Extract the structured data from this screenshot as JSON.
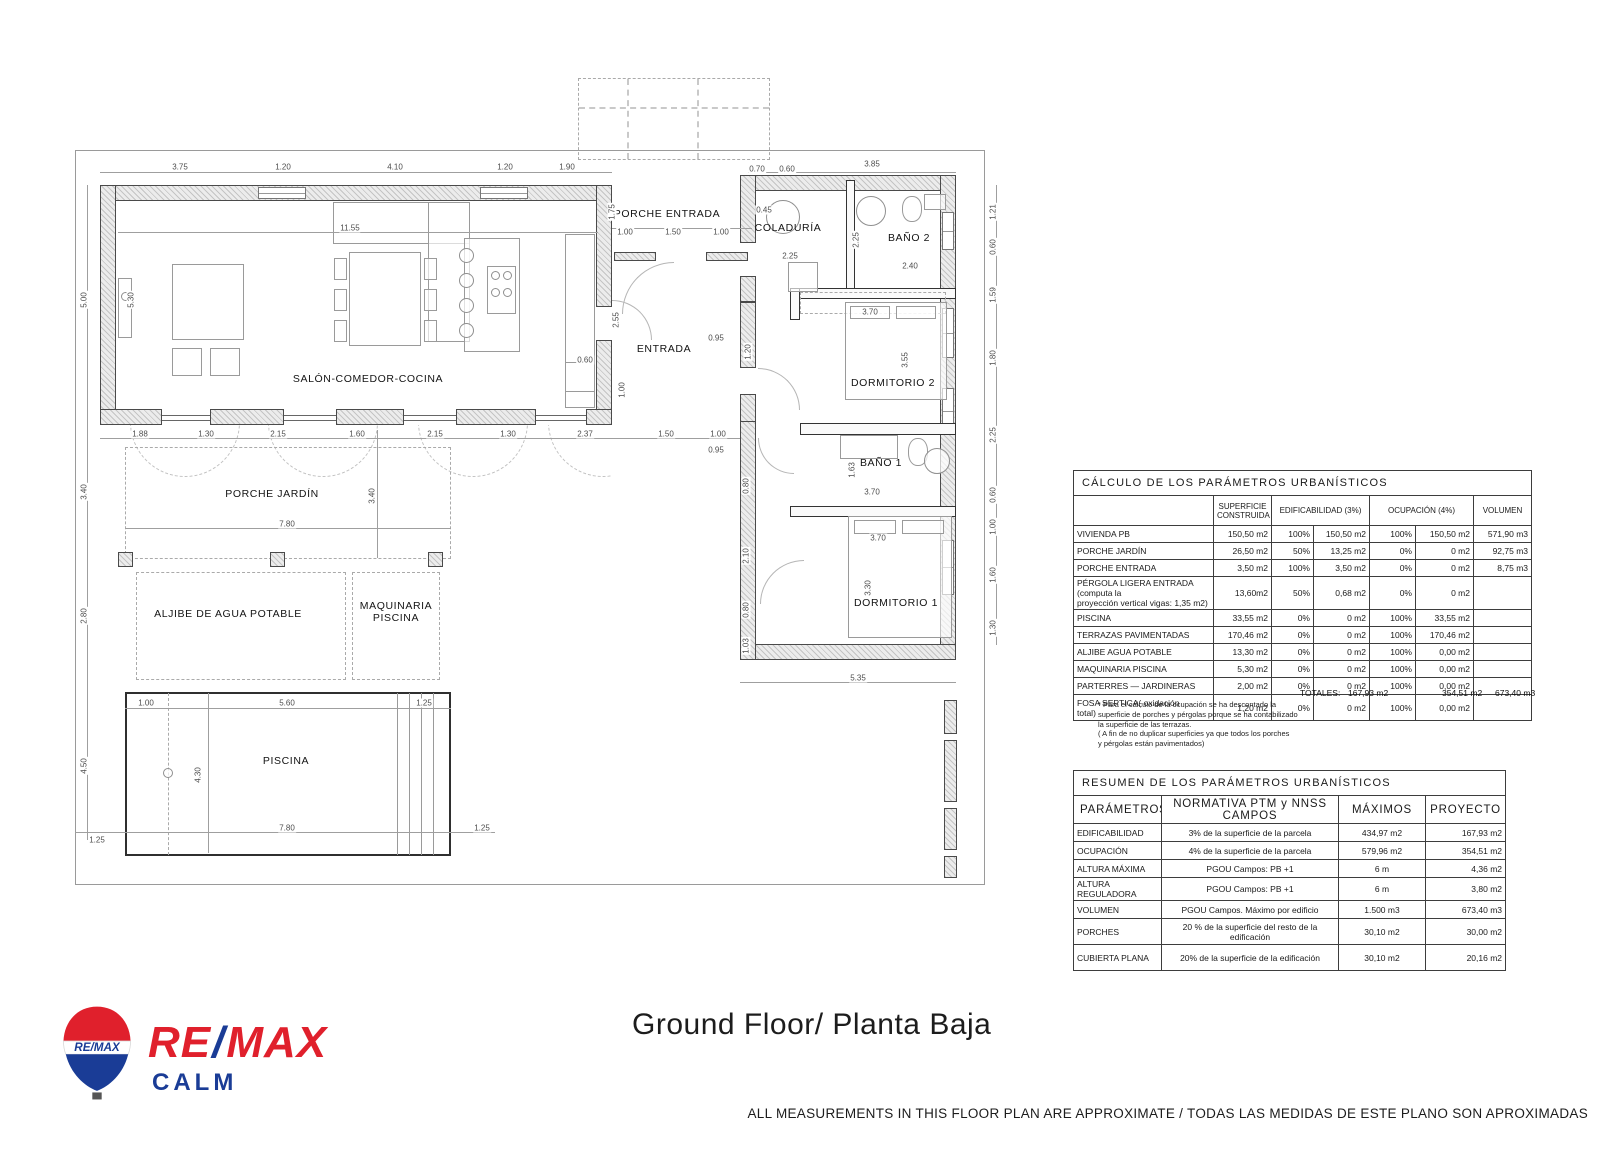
{
  "meta": {
    "title": "Ground Floor/ Planta Baja",
    "disclaimer": "ALL MEASUREMENTS IN THIS FLOOR PLAN ARE APPROXIMATE / TODAS LAS MEDIDAS DE ESTE PLANO SON APROXIMADAS"
  },
  "logo": {
    "balloon_text": "RE/MAX",
    "brand_left": "RE",
    "brand_slash": "/",
    "brand_right": "MAX",
    "office": "CALM",
    "red": "#e0202c",
    "blue": "#1a3c96"
  },
  "plan": {
    "rooms": [
      {
        "id": "salon",
        "label": "SALÓN-COMEDOR-COCINA",
        "x": 368,
        "y": 379
      },
      {
        "id": "porche-entrada",
        "label": "PORCHE ENTRADA",
        "x": 667,
        "y": 214
      },
      {
        "id": "coladuria",
        "label": "COLADURÍA",
        "x": 788,
        "y": 228
      },
      {
        "id": "bano-2",
        "label": "BAÑO 2",
        "x": 909,
        "y": 238
      },
      {
        "id": "entrada",
        "label": "ENTRADA",
        "x": 664,
        "y": 349
      },
      {
        "id": "dormitorio-2",
        "label": "DORMITORIO 2",
        "x": 893,
        "y": 383
      },
      {
        "id": "bano-1",
        "label": "BAÑO 1",
        "x": 881,
        "y": 463
      },
      {
        "id": "dormitorio-1",
        "label": "DORMITORIO 1",
        "x": 896,
        "y": 603
      },
      {
        "id": "porche-jardin",
        "label": "PORCHE JARDÍN",
        "x": 272,
        "y": 494
      },
      {
        "id": "aljibe",
        "label": "ALJIBE DE AGUA POTABLE",
        "x": 228,
        "y": 614
      },
      {
        "id": "maquinaria",
        "label": "MAQUINARIA\nPISCINA",
        "x": 396,
        "y": 612
      },
      {
        "id": "piscina",
        "label": "PISCINA",
        "x": 286,
        "y": 761
      }
    ],
    "dimensions": [
      {
        "t": "3.75",
        "x": 180,
        "y": 167
      },
      {
        "t": "1.20",
        "x": 283,
        "y": 167
      },
      {
        "t": "4.10",
        "x": 395,
        "y": 167
      },
      {
        "t": "1.20",
        "x": 505,
        "y": 167
      },
      {
        "t": "1.90",
        "x": 567,
        "y": 167
      },
      {
        "t": "0.70",
        "x": 757,
        "y": 169
      },
      {
        "t": "0.60",
        "x": 787,
        "y": 169
      },
      {
        "t": "3.85",
        "x": 872,
        "y": 164
      },
      {
        "t": "11.55",
        "x": 350,
        "y": 228
      },
      {
        "t": "5.00",
        "x": 84,
        "y": 300,
        "r": 1
      },
      {
        "t": "5.30",
        "x": 131,
        "y": 300,
        "r": 1
      },
      {
        "t": "3.40",
        "x": 84,
        "y": 492,
        "r": 1
      },
      {
        "t": "2.80",
        "x": 84,
        "y": 616,
        "r": 1
      },
      {
        "t": "4.50",
        "x": 84,
        "y": 766,
        "r": 1
      },
      {
        "t": "1.25",
        "x": 97,
        "y": 840
      },
      {
        "t": "1.88",
        "x": 140,
        "y": 434
      },
      {
        "t": "1.30",
        "x": 206,
        "y": 434
      },
      {
        "t": "2.15",
        "x": 278,
        "y": 434
      },
      {
        "t": "1.60",
        "x": 357,
        "y": 434
      },
      {
        "t": "2.15",
        "x": 435,
        "y": 434
      },
      {
        "t": "1.30",
        "x": 508,
        "y": 434
      },
      {
        "t": "2.37",
        "x": 585,
        "y": 434
      },
      {
        "t": "1.50",
        "x": 666,
        "y": 434
      },
      {
        "t": "1.00",
        "x": 718,
        "y": 434
      },
      {
        "t": "7.80",
        "x": 287,
        "y": 524
      },
      {
        "t": "3.40",
        "x": 372,
        "y": 496,
        "r": 1
      },
      {
        "t": "1.00",
        "x": 146,
        "y": 703
      },
      {
        "t": "5.60",
        "x": 287,
        "y": 703
      },
      {
        "t": "1.25",
        "x": 424,
        "y": 703
      },
      {
        "t": "4.30",
        "x": 198,
        "y": 775,
        "r": 1
      },
      {
        "t": "7.80",
        "x": 287,
        "y": 828
      },
      {
        "t": "1.25",
        "x": 482,
        "y": 828
      },
      {
        "t": "1.00",
        "x": 625,
        "y": 232
      },
      {
        "t": "1.50",
        "x": 673,
        "y": 232
      },
      {
        "t": "1.00",
        "x": 721,
        "y": 232
      },
      {
        "t": "1.75",
        "x": 612,
        "y": 212,
        "r": 1
      },
      {
        "t": "2.55",
        "x": 616,
        "y": 320,
        "r": 1
      },
      {
        "t": "0.60",
        "x": 585,
        "y": 360
      },
      {
        "t": "1.00",
        "x": 622,
        "y": 390,
        "r": 1
      },
      {
        "t": "0.95",
        "x": 716,
        "y": 338
      },
      {
        "t": "1.20",
        "x": 748,
        "y": 352,
        "r": 1
      },
      {
        "t": "0.45",
        "x": 764,
        "y": 210
      },
      {
        "t": "2.25",
        "x": 790,
        "y": 256
      },
      {
        "t": "2.25",
        "x": 856,
        "y": 240,
        "r": 1
      },
      {
        "t": "2.40",
        "x": 910,
        "y": 266
      },
      {
        "t": "3.70",
        "x": 870,
        "y": 312
      },
      {
        "t": "3.55",
        "x": 905,
        "y": 360,
        "r": 1
      },
      {
        "t": "0.95",
        "x": 716,
        "y": 450
      },
      {
        "t": "3.70",
        "x": 872,
        "y": 492
      },
      {
        "t": "1.63",
        "x": 852,
        "y": 470,
        "r": 1
      },
      {
        "t": "3.70",
        "x": 878,
        "y": 538
      },
      {
        "t": "3.30",
        "x": 868,
        "y": 588,
        "r": 1
      },
      {
        "t": "5.35",
        "x": 858,
        "y": 678
      },
      {
        "t": "0.80",
        "x": 746,
        "y": 486,
        "r": 1
      },
      {
        "t": "2.10",
        "x": 746,
        "y": 556,
        "r": 1
      },
      {
        "t": "0.80",
        "x": 746,
        "y": 610,
        "r": 1
      },
      {
        "t": "1.03",
        "x": 746,
        "y": 646,
        "r": 1
      },
      {
        "t": "1.21",
        "x": 993,
        "y": 212,
        "r": 1
      },
      {
        "t": "0.60",
        "x": 993,
        "y": 247,
        "r": 1
      },
      {
        "t": "1.59",
        "x": 993,
        "y": 295,
        "r": 1
      },
      {
        "t": "1.80",
        "x": 993,
        "y": 358,
        "r": 1
      },
      {
        "t": "2.25",
        "x": 993,
        "y": 435,
        "r": 1
      },
      {
        "t": "0.60",
        "x": 993,
        "y": 495,
        "r": 1
      },
      {
        "t": "1.00",
        "x": 993,
        "y": 527,
        "r": 1
      },
      {
        "t": "1.60",
        "x": 993,
        "y": 575,
        "r": 1
      },
      {
        "t": "1.30",
        "x": 993,
        "y": 628,
        "r": 1
      }
    ]
  },
  "calc_table": {
    "title": "CÁLCULO  DE  LOS    PARÁMETROS  URBANÍSTICOS",
    "col_headers": {
      "superficie": "SUPERFICIE\nCONSTRUIDA",
      "edificabilidad": "EDIFICABILIDAD  (3%)",
      "ocupacion": "OCUPACIÓN    (4%)",
      "volumen": "VOLUMEN"
    },
    "rows": [
      [
        "VIVIENDA PB",
        "150,50 m2",
        "100%",
        "150,50 m2",
        "100%",
        "150,50 m2",
        "571,90  m3"
      ],
      [
        "PORCHE JARDÍN",
        "26,50  m2",
        "50%",
        "13,25  m2",
        "0%",
        "0  m2",
        "92,75  m3"
      ],
      [
        "PORCHE ENTRADA",
        "3,50 m2",
        "100%",
        "3,50 m2",
        "0%",
        "0  m2",
        "8,75  m3"
      ],
      [
        "PÉRGOLA LIGERA ENTRADA    (computa la\nproyección vertical vigas: 1,35 m2)",
        "13,60m2",
        "50%",
        "0,68 m2",
        "0%",
        "0  m2",
        ""
      ],
      [
        "PISCINA",
        "33,55 m2",
        "0%",
        "0  m2",
        "100%",
        "33,55  m2",
        ""
      ],
      [
        "TERRAZAS PAVIMENTADAS",
        "170,46 m2",
        "0%",
        "0  m2",
        "100%",
        "170,46  m2",
        ""
      ],
      [
        "ALJIBE AGUA POTABLE",
        "13,30 m2",
        "0%",
        "0  m2",
        "100%",
        "0,00  m2",
        ""
      ],
      [
        "MAQUINARIA PISCINA",
        "5,30 m2",
        "0%",
        "0  m2",
        "100%",
        "0,00  m2",
        ""
      ],
      [
        "PARTERRES — JARDINERAS",
        "2,00 m2",
        "0%",
        "0  m2",
        "100%",
        "0,00  m2",
        ""
      ],
      [
        "FOSA SEPTICA( oxidación\ntotal)",
        "1,20 m2",
        "0%",
        "0  m2",
        "100%",
        "0,00  m2",
        ""
      ]
    ],
    "totales_label": "TOTALES:",
    "totales": [
      "167,93  m2",
      "354,51  m2",
      "673,40  m3"
    ],
    "footnote": "*   Para el cálculo de la ocupación se ha descontado la\n     superficie de porches y pérgolas porque se ha contabilizado\n     la superficie de las terrazas.\n     ( A fin de no duplicar superficies ya que todos los porches\n     y pérgolas están pavimentados)"
  },
  "resumen_table": {
    "title": "RESUMEN  DE  LOS    PARÁMETROS  URBANÍSTICOS",
    "headers": [
      "PARÁMETROS",
      "NORMATIVA  PTM  y  NNSS  CAMPOS",
      "MÁXIMOS",
      "PROYECTO"
    ],
    "rows": [
      [
        "EDIFICABILIDAD",
        "3% de la superficie de la parcela",
        "434,97 m2",
        "167,93   m2"
      ],
      [
        "OCUPACIÓN",
        "4% de la superficie de la parcela",
        "579,96 m2",
        "354,51   m2"
      ],
      [
        "ALTURA MÁXIMA",
        "PGOU Campos: PB +1",
        "6 m",
        "4,36   m2"
      ],
      [
        "ALTURA REGULADORA",
        "PGOU Campos: PB +1",
        "6 m",
        "3,80   m2"
      ],
      [
        "VOLUMEN",
        "PGOU Campos. Máximo por edificio",
        "1.500 m3",
        "673,40   m3"
      ],
      [
        "PORCHES",
        "20 % de la superficie del resto de la\nedificación",
        "30,10 m2",
        "30,00  m2"
      ],
      [
        "CUBIERTA PLANA",
        "20% de la superficie de la\nedificación",
        "30,10 m2",
        "20,16   m2"
      ]
    ]
  }
}
